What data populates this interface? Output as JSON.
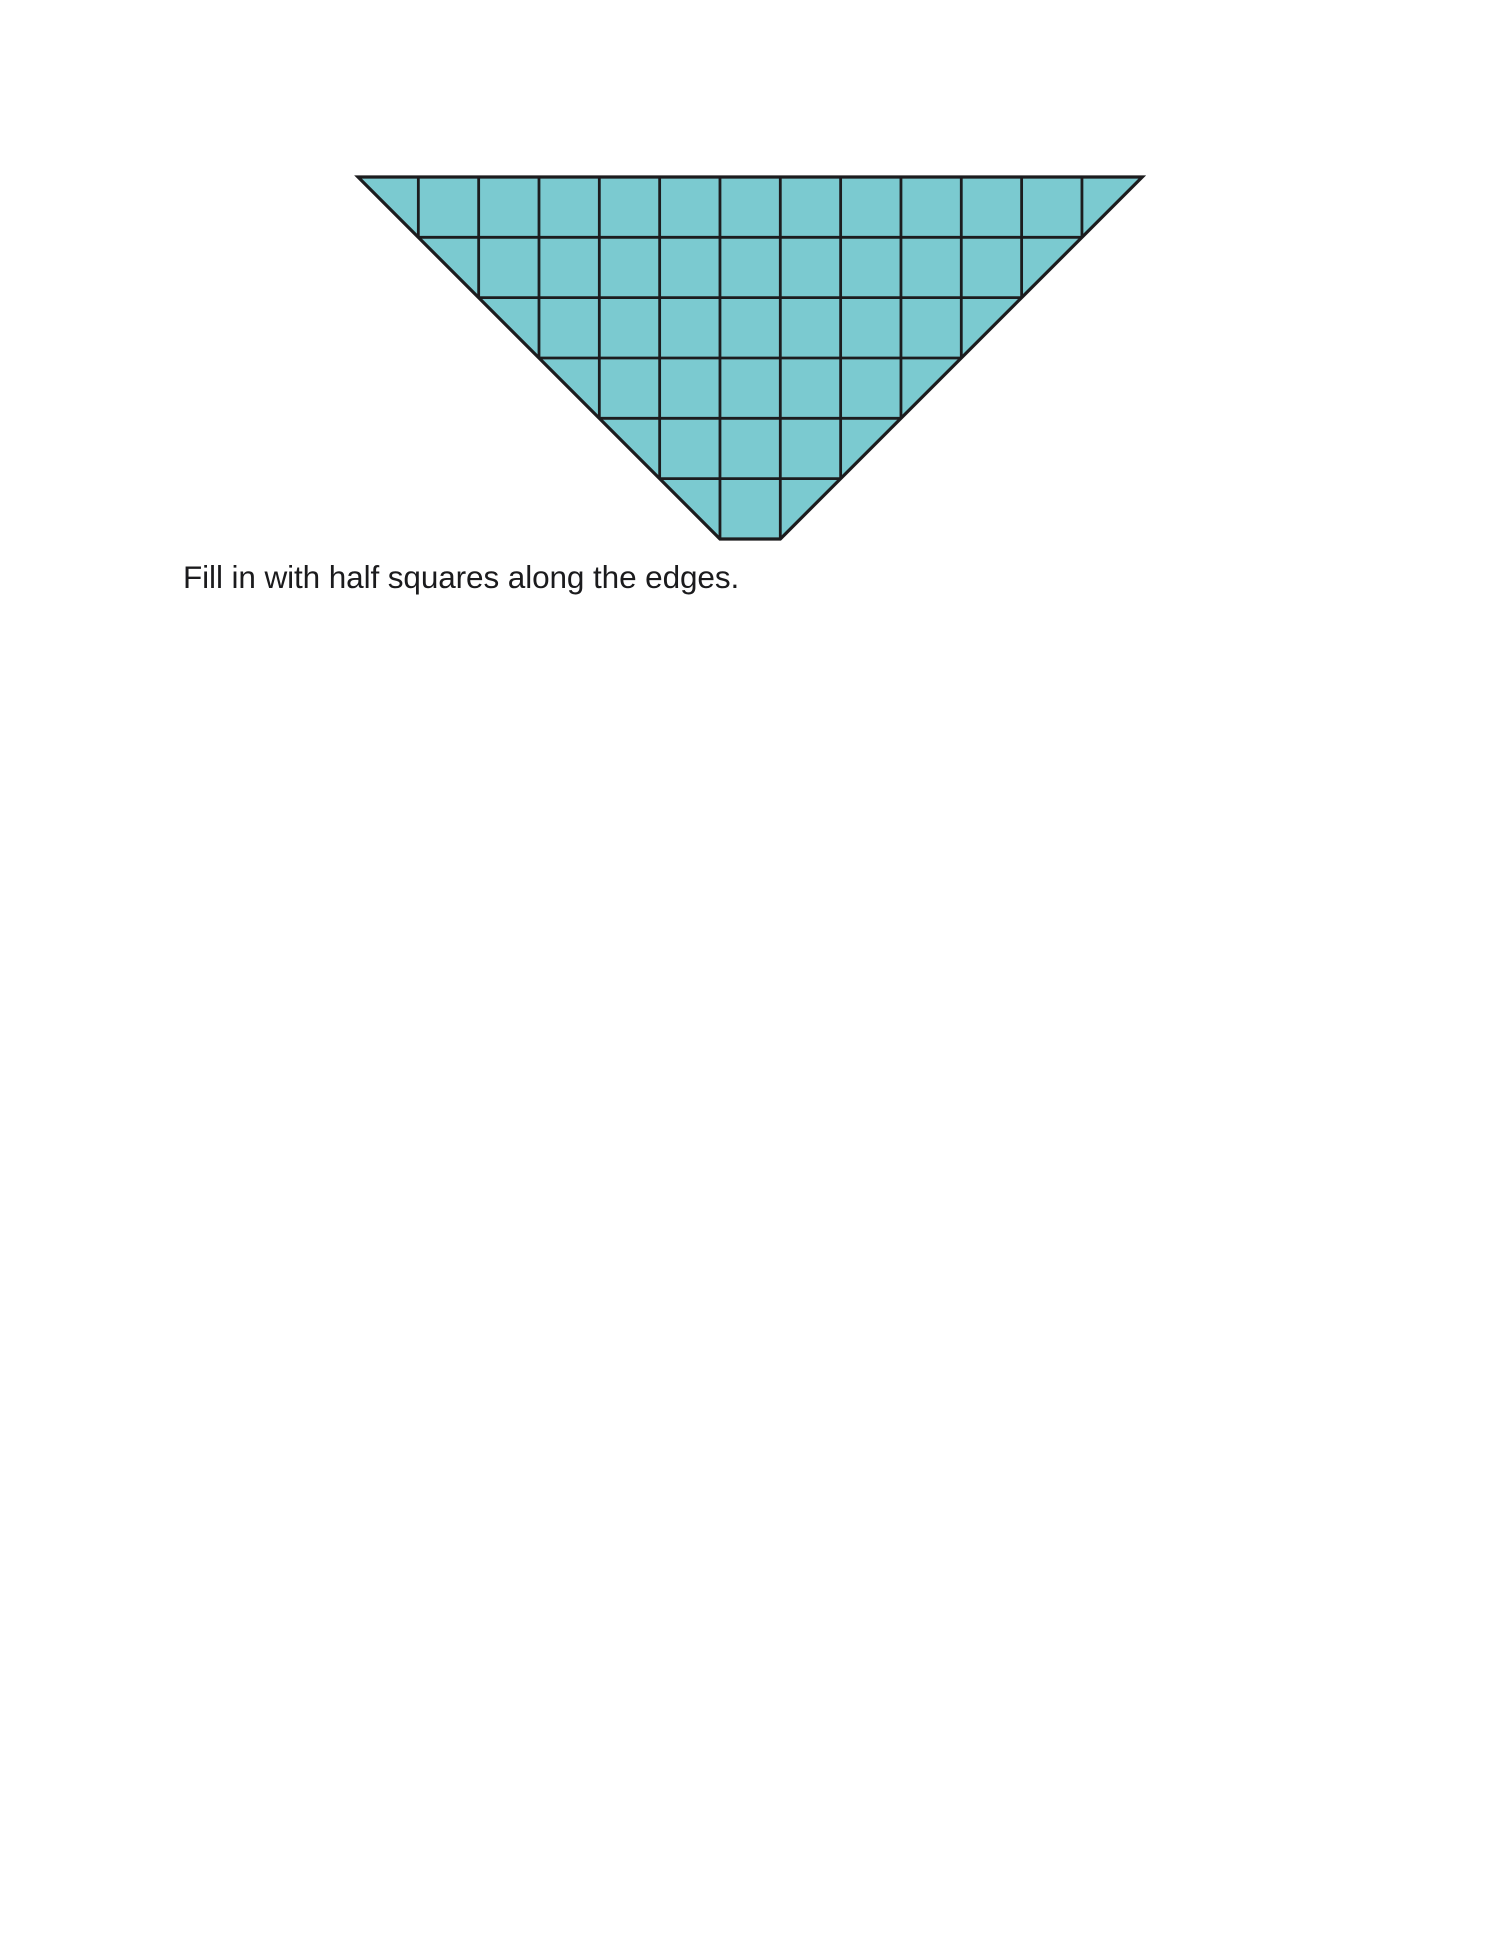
{
  "page": {
    "background_color": "#ffffff"
  },
  "caption": {
    "text": "Fill in with half squares along the edges."
  },
  "caption_pos": {
    "left_px": 183,
    "top_px": 559
  },
  "figure": {
    "shape": "inverted-triangle-grid",
    "description": "Point-down isosceles right triangle built on a square grid; top edge is 13 cells wide, 6 rows deep, tip truncated flat at one cell wide; cells along the two diagonal edges are half squares filled in with the same color.",
    "columns_top": 13,
    "rows": 6,
    "cell_px": 60.33,
    "full_squares_per_row": [
      11,
      9,
      7,
      5,
      3,
      1
    ],
    "half_squares_per_row": 2,
    "total_full_squares": 36,
    "fill_color": "#7bcad0",
    "line_color": "#1c1c1e",
    "outline_stroke_px": 3.2,
    "grid_stroke_px": 2.8,
    "left_px": 358,
    "top_px": 177
  }
}
